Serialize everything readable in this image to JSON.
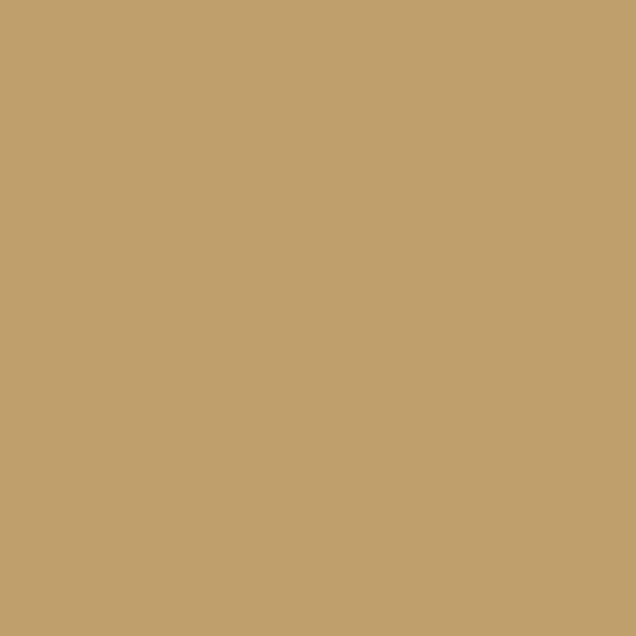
{
  "canvas": {
    "background_color": "#BFA06C",
    "width_px": 636,
    "height_px": 636,
    "description": "Uniform solid tan/camel colored field with no visible text, icons, or UI elements"
  }
}
